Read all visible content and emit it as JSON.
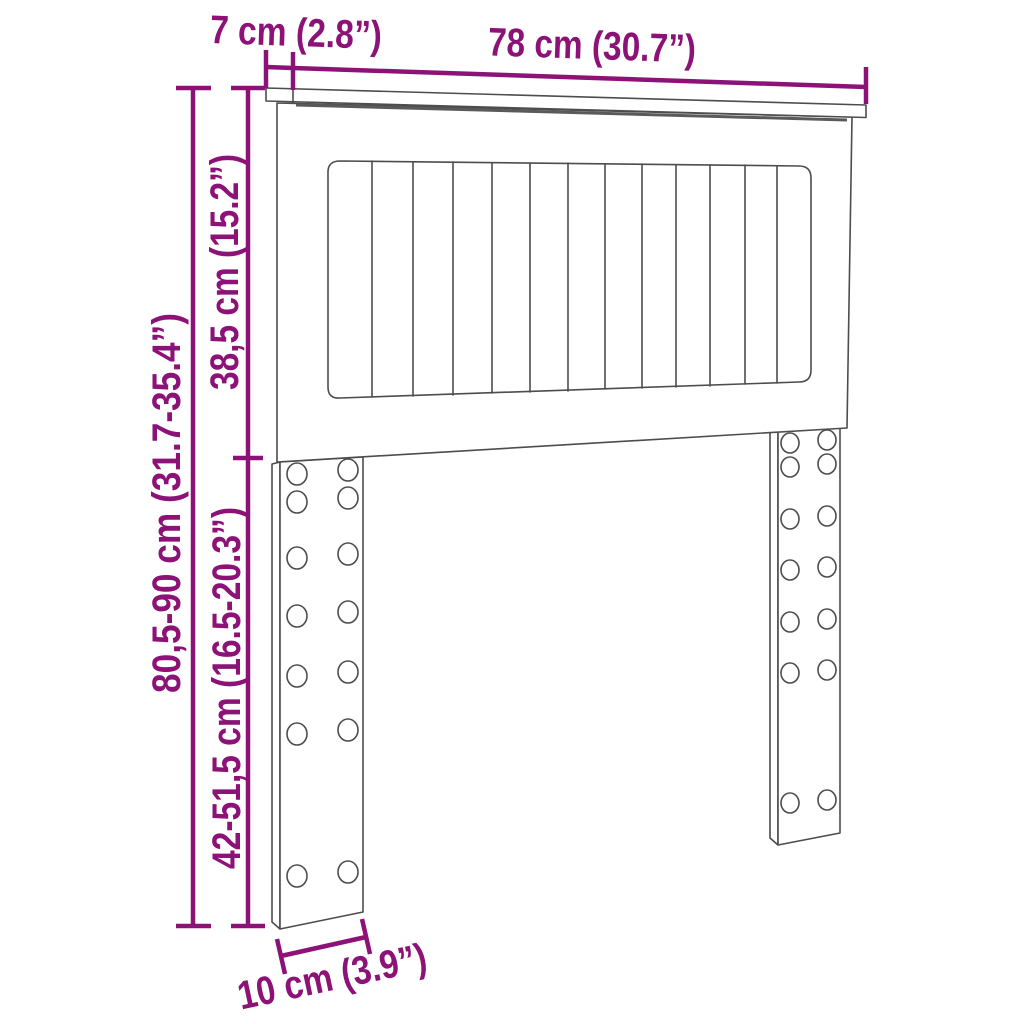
{
  "diagram": {
    "title": "headboard dimension diagram",
    "product": "headboard with slatted panel and two pre-drilled legs",
    "style": "line-art perspective drawing",
    "colors": {
      "dimension_accent": "#8C1277",
      "line_art": "#4d4d4d",
      "shadow": "#5a5a5a",
      "background": "#ffffff"
    },
    "dims": {
      "top_depth": {
        "label": "7 cm (2.8”)",
        "measures": "depth of top shelf board"
      },
      "width": {
        "label": "78 cm (30.7”)",
        "measures": "overall width of top board"
      },
      "panel_height": {
        "label": "38,5 cm (15.2”)",
        "measures": "height of headboard panel"
      },
      "total_height": {
        "label": "80,5-90 cm (31.7-35.4”)",
        "measures": "overall adjustable height"
      },
      "leg_height": {
        "label": "42-51,5 cm (16.5-20.3”)",
        "measures": "adjustable leg height"
      },
      "leg_width": {
        "label": "10 cm (3.9”)",
        "measures": "width of leg"
      }
    },
    "features": {
      "slat_count": 13,
      "legs": 2,
      "holes_per_leg": 14,
      "hole_columns_per_leg": 2,
      "hole_rows_per_leg": 7
    }
  }
}
